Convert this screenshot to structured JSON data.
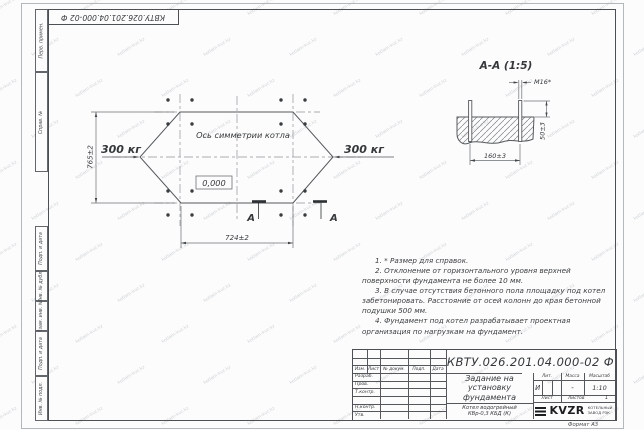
{
  "watermark": {
    "text": "kotlam-kvz.kz"
  },
  "frame": {
    "side_labels": [
      "Перв. примен.",
      "Справ. №",
      "Подп. и дата",
      "Инв. № дубл.",
      "Взам. инв. №",
      "Подп. и дата",
      "Инв. № подл."
    ],
    "format_label": "Формат А3"
  },
  "plan": {
    "axis_label": "Ось симметрии котла",
    "load_left": "300 кг",
    "load_right": "300 кг",
    "elevation": "0,000",
    "dim_height": "765±2",
    "dim_width": "724±2",
    "section_letter_left": "А",
    "section_letter_right": "А"
  },
  "section": {
    "title": "А-А (1:5)",
    "bolt_label": "М16*",
    "dim_span": "160±3",
    "dim_height": "50±3"
  },
  "notes": [
    "1. * Размер для справок.",
    "2. Отклонение от горизонтального уровня верхней поверхности фундамента не более 10 мм.",
    "3. В случае отсутствия бетонного пола площадку под котел забетонировать. Расстояние от осей колонн до края бетонной подушки 500 мм.",
    "4. Фундамент под котел разрабатывает проектная организация по нагрузкам на фундамент."
  ],
  "title_block": {
    "doc_number": "КВТУ.026.201.04.000-02  Ф",
    "title": "Задание на установку фундамента",
    "product": "Котел водогрейный КВр-0,3 КБД (К)",
    "header_cols": [
      "Изм.",
      "Лист",
      "№ докум.",
      "Подп.",
      "Дата"
    ],
    "row_labels": [
      "Разраб.",
      "Пров.",
      "Т.контр.",
      "Н.контр.",
      "Утв."
    ],
    "lit_label": "Лит.",
    "lit_value": "И",
    "mass_label": "Масса",
    "mass_value": "-",
    "scale_label": "Масштаб",
    "scale_value": "1:10",
    "sheet_label": "Лист",
    "sheets_label": "Листов",
    "sheets_value": "1",
    "company_logo": "KVZR",
    "company_name_line1": "КОТЕЛЬНЫЙ",
    "company_name_line2": "ЗАВОД РЗК"
  }
}
